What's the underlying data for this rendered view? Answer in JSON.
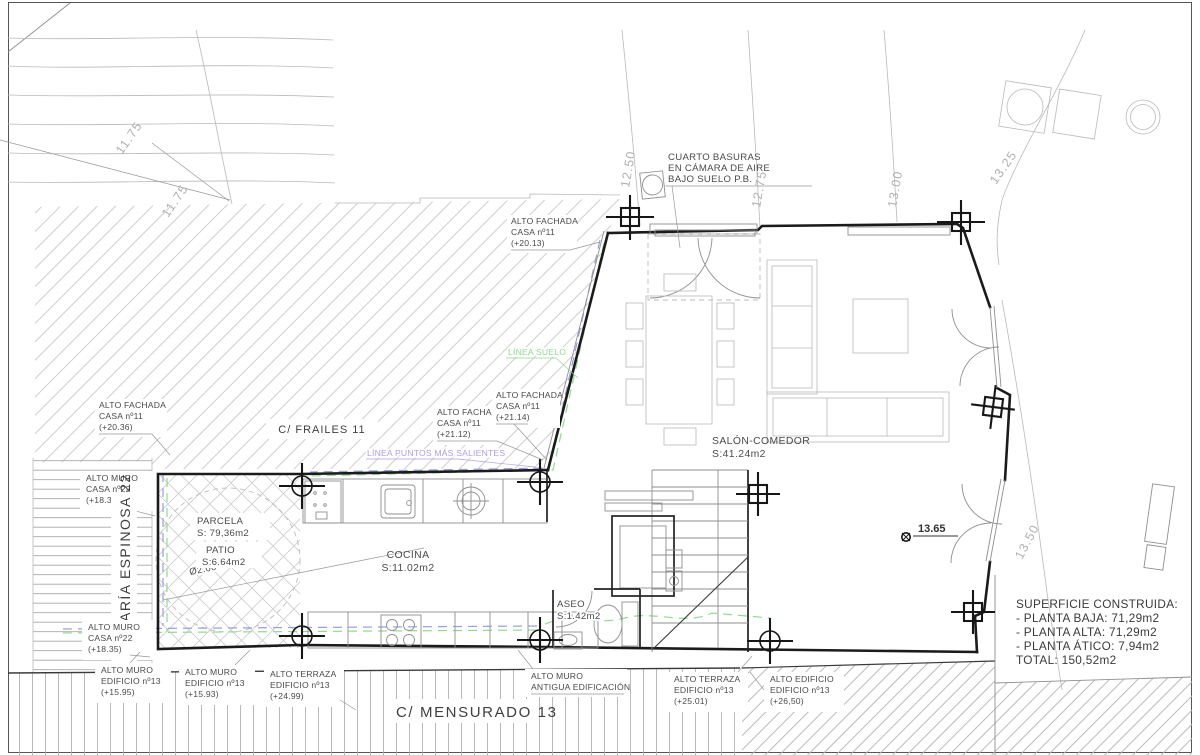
{
  "drawing": {
    "streets": {
      "frailes": "C/ FRAILES 11",
      "maria_espinosa": "C/ MARÍA ESPINOSA 22",
      "mensurado": "C/ MENSURADO 13"
    },
    "rooms": {
      "salon": {
        "name": "SALÓN-COMEDOR",
        "area": "S:41.24m2"
      },
      "cocina": {
        "name": "COCINA",
        "area": "S:11.02m2"
      },
      "aseo": {
        "name": "ASEO",
        "area": "S:1.42m2"
      },
      "parcela": {
        "name": "PARCELA",
        "area": "S: 79,36m2"
      },
      "patio": {
        "name": "PATIO",
        "area": "S:6.64m2"
      }
    },
    "labels": {
      "cuarto_basuras": [
        "CUARTO BASURAS",
        "EN CÁMARA DE AIRE",
        "BAJO SUELO P.B."
      ],
      "fachada_20_13": [
        "ALTO FACHADA",
        "CASA nº11",
        "(+20.13)"
      ],
      "fachada_20_36": [
        "ALTO FACHADA",
        "CASA nº11",
        "(+20.36)"
      ],
      "fachada_21_12": [
        "ALTO FACHADA",
        "CASA nº11",
        "(+21.12)"
      ],
      "fachada_21_14": [
        "ALTO FACHADA",
        "CASA nº11",
        "(+21.14)"
      ],
      "muro_18_33": [
        "ALTO MURO",
        "CASA nº22",
        "(+18.33)"
      ],
      "muro_18_35": [
        "ALTO MURO",
        "CASA nº22",
        "(+18.35)"
      ],
      "muro_15_95": [
        "ALTO MURO",
        "EDIFICIO nº13",
        "(+15.95)"
      ],
      "muro_15_93": [
        "ALTO MURO",
        "EDIFICIO nº13",
        "(+15.93)"
      ],
      "terraza_24_99": [
        "ALTO TERRAZA",
        "EDIFICIO nº13",
        "(+24.99)"
      ],
      "muro_antigua": [
        "ALTO MURO",
        "ANTIGUA EDIFICACIÓN"
      ],
      "terraza_25_01": [
        "ALTO TERRAZA",
        "EDIFICIO nº13",
        "(+25.01)"
      ],
      "edificio_26_50": [
        "ALTO EDIFICIO",
        "EDIFICIO nº13",
        "(+26,50)"
      ],
      "linea_puntos": "LÍNEA PUNTOS MÁS SALIENTES",
      "linea_suelo": "LÍNEA SUELO",
      "diam": "Ø2.00"
    },
    "levels": {
      "v11_75": "11.75",
      "v12_50": "12.50",
      "v12_75": "12.75",
      "v13_00": "13.00",
      "v13_25": "13.25",
      "v13_50": "13.50",
      "spot": "13.65"
    },
    "summary": {
      "title": "SUPERFICIE CONSTRUIDA:",
      "rows": [
        "- PLANTA BAJA: 71,29m2",
        "- PLANTA ALTA: 71,29m2",
        "- PLANTA ÁTICO: 7,94m2",
        "TOTAL: 150,52m2"
      ]
    },
    "colors": {
      "wall": "#1b1b1b",
      "thin_gray": "#8f8f8f",
      "hatch_gray": "#c9c9c9",
      "dash_purple": "#9b9bdf",
      "dash_green": "#8fdc8f",
      "text_purple": "#b29de0",
      "text_green": "#93d793"
    }
  }
}
